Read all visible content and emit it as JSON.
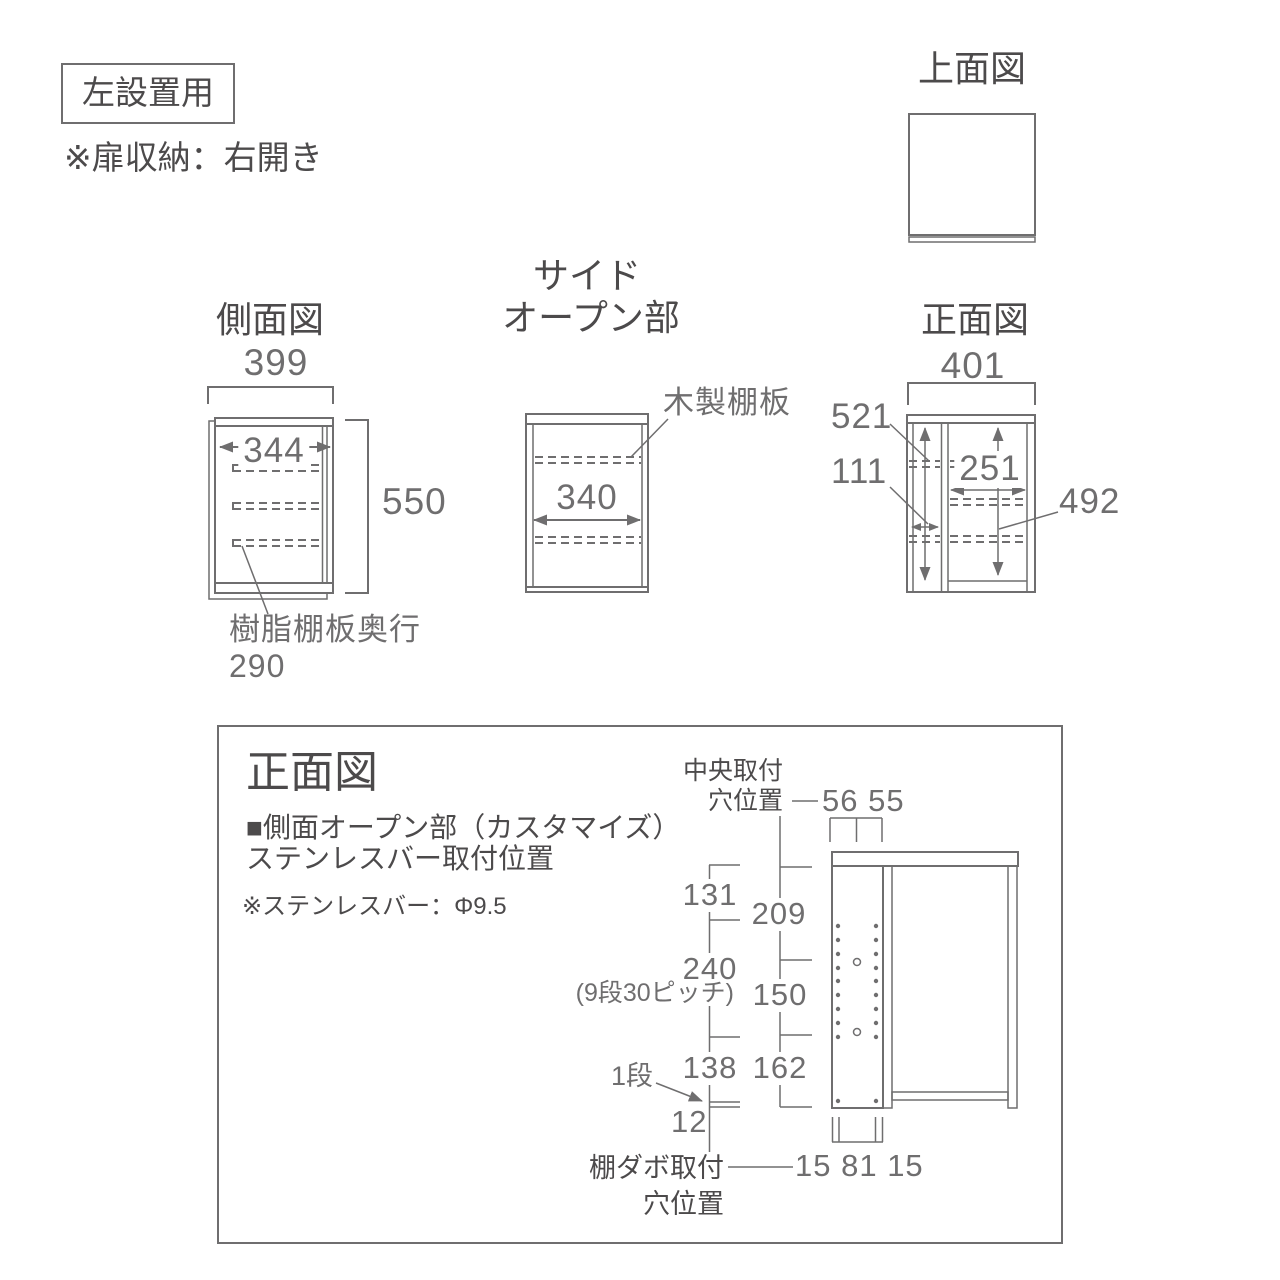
{
  "colors": {
    "line": "#6f6e6f",
    "heading": "#4c4a4b",
    "dim_text": "#6f6e6f",
    "background": "#ffffff"
  },
  "header": {
    "badge": "左設置用",
    "note": "※扉収納：右開き"
  },
  "top_view": {
    "title": "上面図"
  },
  "side_view": {
    "title": "側面図",
    "width": "399",
    "inner_width": "344",
    "height": "550",
    "resin_shelf_label": "樹脂棚板奥行",
    "resin_shelf_depth": "290"
  },
  "side_open": {
    "title_line1": "サイド",
    "title_line2": "オープン部",
    "inner_width": "340",
    "wood_shelf_label": "木製棚板"
  },
  "front_view": {
    "title": "正面図",
    "width": "401",
    "left_height": "521",
    "left_width": "111",
    "right_width": "251",
    "right_height": "492"
  },
  "detail": {
    "title": "正面図",
    "subtitle": "■側面オープン部（カスタマイズ）",
    "subtitle2": "ステンレスバー取付位置",
    "bar_note": "※ステンレスバー：Φ9.5",
    "center_label1": "中央取付",
    "center_label2": "穴位置",
    "center_dims": "56 55",
    "seg_131": "131",
    "seg_209": "209",
    "seg_240": "240",
    "seg_240_note": "(9段30ピッチ)",
    "seg_150": "150",
    "seg_138": "138",
    "seg_162": "162",
    "seg_12": "12",
    "step_label": "1段",
    "dowel_label1": "棚ダボ取付",
    "dowel_label2": "穴位置",
    "dowel_dims": "15 81 15"
  }
}
